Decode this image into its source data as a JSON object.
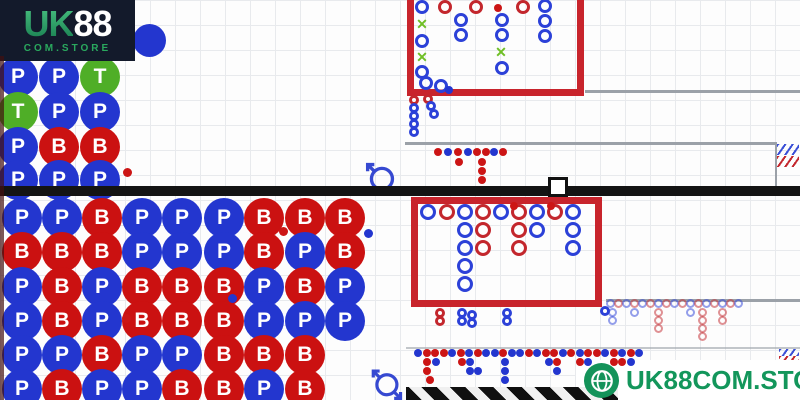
{
  "logo": {
    "uk": "UK",
    "eights": "88",
    "store": "COM.STORE"
  },
  "badge": {
    "label": "UK88COM.STORE"
  },
  "colors": {
    "player_blue": "#2336cf",
    "banker_red": "#cb1111",
    "tie_green": "#4fae27",
    "road_box_red": "#c8242c",
    "x_green": "#6fbf25",
    "badge_green": "#14935a",
    "logo_bg": "#131a2b"
  },
  "top_bead_plate": {
    "d": 40,
    "cols": [
      18,
      59,
      100
    ],
    "rows": [
      77,
      112,
      147,
      180
    ],
    "cells": [
      [
        "P",
        "P",
        "T"
      ],
      [
        "T",
        "P",
        "P"
      ],
      [
        "P",
        "B",
        "B"
      ],
      [
        "P",
        "P",
        "P"
      ]
    ]
  },
  "bottom_bead_plate": {
    "d": 40,
    "cols": [
      22,
      62,
      102,
      142,
      182,
      224,
      264,
      305,
      345
    ],
    "rows": [
      218,
      252,
      287,
      321,
      355,
      389
    ],
    "cells": [
      [
        "P",
        "P",
        "B",
        "P",
        "P",
        "P",
        "B",
        "B",
        "B"
      ],
      [
        "B",
        "B",
        "B",
        "P",
        "P",
        "P",
        "B",
        "P",
        "B"
      ],
      [
        "P",
        "B",
        "P",
        "B",
        "B",
        "B",
        "P",
        "B",
        "P"
      ],
      [
        "P",
        "B",
        "P",
        "B",
        "B",
        "B",
        "P",
        "P",
        "P"
      ],
      [
        "P",
        "P",
        "B",
        "P",
        "P",
        "B",
        "B",
        "B",
        ""
      ],
      [
        "P",
        "B",
        "P",
        "P",
        "B",
        "B",
        "P",
        "B",
        ""
      ]
    ]
  },
  "mark_groups": [
    {
      "name": "top-road",
      "size": 14,
      "dot": 8,
      "items": [
        [
          422,
          7,
          "b"
        ],
        [
          445,
          7,
          "r"
        ],
        [
          476,
          7,
          "r"
        ],
        [
          498,
          8,
          "rd"
        ],
        [
          523,
          7,
          "r"
        ],
        [
          545,
          6,
          "b"
        ],
        [
          422,
          24,
          "x"
        ],
        [
          422,
          41,
          "b"
        ],
        [
          422,
          57,
          "x"
        ],
        [
          422,
          72,
          "b"
        ],
        [
          426,
          83,
          "b"
        ],
        [
          441,
          86,
          "b"
        ],
        [
          449,
          90,
          "bd"
        ],
        [
          461,
          20,
          "b"
        ],
        [
          461,
          35,
          "b"
        ],
        [
          502,
          20,
          "b"
        ],
        [
          502,
          35,
          "b"
        ],
        [
          501,
          52,
          "x"
        ],
        [
          502,
          68,
          "b"
        ],
        [
          545,
          21,
          "b"
        ],
        [
          545,
          36,
          "b"
        ]
      ]
    },
    {
      "name": "top-road-tail",
      "size": 10,
      "dot": 6,
      "items": [
        [
          414,
          100,
          "r"
        ],
        [
          414,
          108,
          "b"
        ],
        [
          414,
          116,
          "b"
        ],
        [
          414,
          124,
          "b"
        ],
        [
          414,
          132,
          "b"
        ],
        [
          428,
          99,
          "r"
        ],
        [
          431,
          106,
          "b"
        ],
        [
          434,
          114,
          "b"
        ]
      ]
    },
    {
      "name": "mid-dots",
      "size": 8,
      "dot": 8,
      "items": [
        [
          438,
          152,
          "rd"
        ],
        [
          448,
          152,
          "bd"
        ],
        [
          458,
          152,
          "rd"
        ],
        [
          468,
          152,
          "bd"
        ],
        [
          477,
          152,
          "rd"
        ],
        [
          486,
          152,
          "rd"
        ],
        [
          494,
          152,
          "bd"
        ],
        [
          503,
          152,
          "rd"
        ],
        [
          459,
          162,
          "rd"
        ],
        [
          482,
          162,
          "rd"
        ],
        [
          482,
          171,
          "rd"
        ],
        [
          482,
          180,
          "rd"
        ]
      ]
    },
    {
      "name": "bottom-road",
      "size": 16,
      "dot": 8,
      "items": [
        [
          428,
          212,
          "b"
        ],
        [
          447,
          212,
          "r"
        ],
        [
          465,
          212,
          "b"
        ],
        [
          483,
          212,
          "r"
        ],
        [
          501,
          212,
          "b"
        ],
        [
          519,
          212,
          "r"
        ],
        [
          537,
          212,
          "b"
        ],
        [
          555,
          212,
          "r"
        ],
        [
          573,
          212,
          "b"
        ],
        [
          514,
          206,
          "rd"
        ],
        [
          551,
          206,
          "rd"
        ],
        [
          465,
          230,
          "b"
        ],
        [
          465,
          248,
          "b"
        ],
        [
          465,
          266,
          "b"
        ],
        [
          465,
          284,
          "b"
        ],
        [
          483,
          230,
          "r"
        ],
        [
          483,
          248,
          "r"
        ],
        [
          519,
          230,
          "r"
        ],
        [
          519,
          248,
          "r"
        ],
        [
          537,
          230,
          "b"
        ],
        [
          573,
          230,
          "b"
        ],
        [
          573,
          248,
          "b"
        ]
      ]
    },
    {
      "name": "bottom-road-tail",
      "size": 10,
      "dot": 6,
      "items": [
        [
          440,
          313,
          "r"
        ],
        [
          440,
          321,
          "r"
        ],
        [
          462,
          313,
          "b"
        ],
        [
          462,
          321,
          "b"
        ],
        [
          472,
          315,
          "b"
        ],
        [
          472,
          323,
          "b"
        ],
        [
          507,
          313,
          "b"
        ],
        [
          507,
          321,
          "b"
        ],
        [
          605,
          311,
          "b"
        ]
      ]
    },
    {
      "name": "right-small-road",
      "size": 9,
      "dot": 6,
      "items": [
        [
          610,
          303,
          "bl"
        ],
        [
          618,
          303,
          "rl"
        ],
        [
          626,
          303,
          "bl"
        ],
        [
          634,
          303,
          "rl"
        ],
        [
          642,
          303,
          "bl"
        ],
        [
          650,
          303,
          "rl"
        ],
        [
          658,
          303,
          "bl"
        ],
        [
          666,
          303,
          "rl"
        ],
        [
          674,
          303,
          "bl"
        ],
        [
          682,
          303,
          "rl"
        ],
        [
          690,
          303,
          "bl"
        ],
        [
          698,
          303,
          "rl"
        ],
        [
          706,
          303,
          "bl"
        ],
        [
          714,
          303,
          "rl"
        ],
        [
          722,
          303,
          "bl"
        ],
        [
          730,
          303,
          "rl"
        ],
        [
          738,
          303,
          "bl"
        ],
        [
          612,
          312,
          "bl"
        ],
        [
          612,
          320,
          "bl"
        ],
        [
          634,
          312,
          "bl"
        ],
        [
          658,
          312,
          "rl"
        ],
        [
          658,
          320,
          "rl"
        ],
        [
          658,
          328,
          "rl"
        ],
        [
          690,
          312,
          "bl"
        ],
        [
          702,
          312,
          "rl"
        ],
        [
          702,
          320,
          "rl"
        ],
        [
          702,
          328,
          "rl"
        ],
        [
          702,
          336,
          "rl"
        ],
        [
          722,
          312,
          "rl"
        ],
        [
          722,
          320,
          "rl"
        ]
      ]
    },
    {
      "name": "bead-accents",
      "size": 9,
      "dot": 9,
      "items": [
        [
          368,
          233,
          "bd"
        ],
        [
          232,
          298,
          "bd"
        ],
        [
          283,
          231,
          "rd"
        ],
        [
          127,
          172,
          "rd"
        ],
        [
          126,
          318,
          "rd"
        ]
      ]
    },
    {
      "name": "bottom-dots",
      "size": 8,
      "dot": 8,
      "items": [
        [
          418,
          353,
          "bd"
        ],
        [
          427,
          353,
          "rd"
        ],
        [
          435,
          353,
          "rd"
        ],
        [
          444,
          353,
          "rd"
        ],
        [
          452,
          353,
          "bd"
        ],
        [
          461,
          353,
          "rd"
        ],
        [
          469,
          353,
          "bd"
        ],
        [
          478,
          353,
          "rd"
        ],
        [
          486,
          353,
          "bd"
        ],
        [
          495,
          353,
          "bd"
        ],
        [
          503,
          353,
          "rd"
        ],
        [
          512,
          353,
          "bd"
        ],
        [
          520,
          353,
          "bd"
        ],
        [
          529,
          353,
          "rd"
        ],
        [
          537,
          353,
          "bd"
        ],
        [
          546,
          353,
          "rd"
        ],
        [
          554,
          353,
          "rd"
        ],
        [
          563,
          353,
          "bd"
        ],
        [
          571,
          353,
          "rd"
        ],
        [
          580,
          353,
          "bd"
        ],
        [
          588,
          353,
          "rd"
        ],
        [
          597,
          353,
          "rd"
        ],
        [
          605,
          353,
          "bd"
        ],
        [
          614,
          353,
          "rd"
        ],
        [
          622,
          353,
          "bd"
        ],
        [
          631,
          353,
          "rd"
        ],
        [
          639,
          353,
          "bd"
        ],
        [
          427,
          362,
          "rd"
        ],
        [
          436,
          362,
          "bd"
        ],
        [
          462,
          362,
          "rd"
        ],
        [
          470,
          362,
          "bd"
        ],
        [
          505,
          362,
          "bd"
        ],
        [
          549,
          362,
          "bd"
        ],
        [
          557,
          362,
          "rd"
        ],
        [
          580,
          362,
          "rd"
        ],
        [
          588,
          362,
          "bd"
        ],
        [
          614,
          362,
          "rd"
        ],
        [
          622,
          362,
          "rd"
        ],
        [
          631,
          362,
          "bd"
        ],
        [
          427,
          371,
          "rd"
        ],
        [
          470,
          371,
          "bd"
        ],
        [
          478,
          371,
          "bd"
        ],
        [
          505,
          371,
          "bd"
        ],
        [
          557,
          371,
          "bd"
        ],
        [
          430,
          380,
          "rd"
        ],
        [
          505,
          380,
          "bd"
        ]
      ]
    }
  ]
}
